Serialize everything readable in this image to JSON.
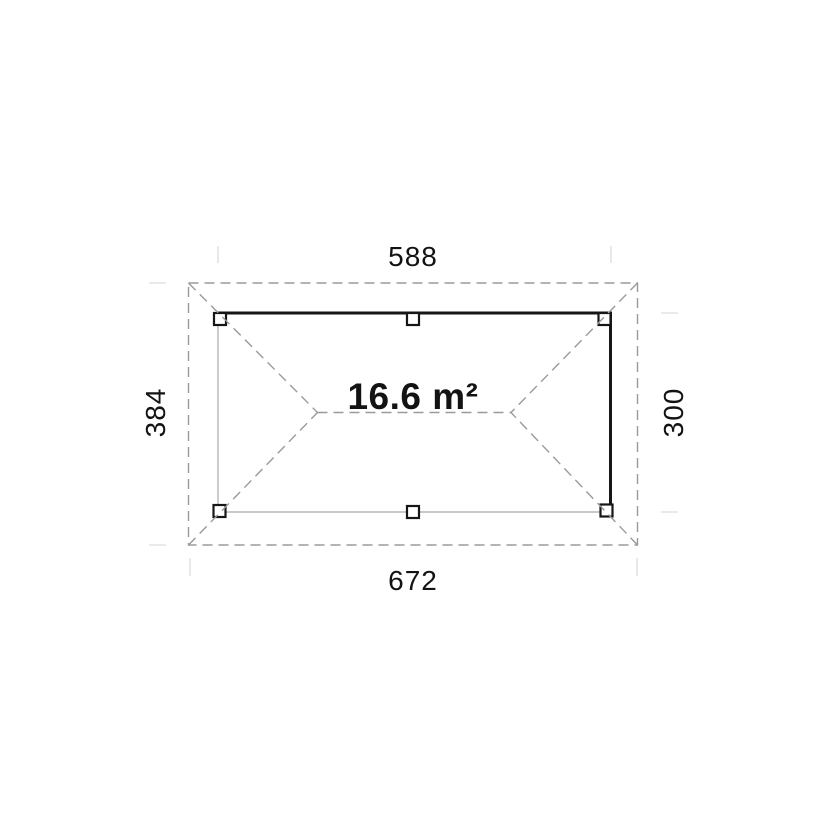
{
  "plan": {
    "area_label": "16.6 m²",
    "dimensions": {
      "top_inner_width": "588",
      "bottom_outer_width": "672",
      "left_outer_depth": "384",
      "right_inner_depth": "300"
    },
    "posts_count": 6,
    "colors": {
      "background": "#ffffff",
      "ink_dark": "#161616",
      "dashed_gray": "#9a9a9a",
      "thin_gray": "#a9a9a9",
      "witness_gray": "#d6d6d6",
      "text": "#131313"
    }
  }
}
